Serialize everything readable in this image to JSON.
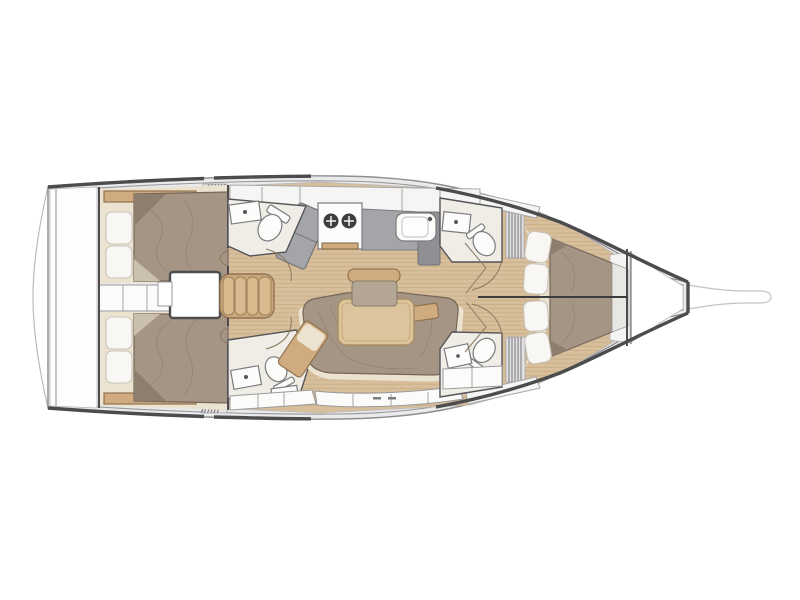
{
  "diagram": {
    "title": "Sailing yacht interior deck plan (top view)",
    "type": "yacht-floor-plan",
    "orientation": {
      "bow": "right",
      "stern": "left",
      "port": "top",
      "starboard": "bottom"
    },
    "layout_version": "4 cabins / 4 heads",
    "rooms": [
      {
        "id": "swim-platform",
        "label": "Swim platform (transom)"
      },
      {
        "id": "lazarette",
        "label": "Stern locker"
      },
      {
        "id": "aft-cabin-port",
        "label": "Aft double cabin - port",
        "furniture": [
          "double berth",
          "2 pillows",
          "shelf trim"
        ]
      },
      {
        "id": "aft-cabin-starboard",
        "label": "Aft double cabin - starboard",
        "furniture": [
          "double berth",
          "2 pillows",
          "shelf trim"
        ]
      },
      {
        "id": "companionway",
        "label": "Companionway steps with engine box"
      },
      {
        "id": "head-aft-port",
        "label": "Aft heads - port",
        "fixtures": [
          "washbasin",
          "toilet"
        ]
      },
      {
        "id": "head-aft-starboard",
        "label": "Aft heads - starboard",
        "fixtures": [
          "washbasin",
          "toilet",
          "shower"
        ]
      },
      {
        "id": "galley",
        "label": "Galley - port side",
        "fixtures": [
          "two-burner stove",
          "sink",
          "refrigerator",
          "cabinets"
        ]
      },
      {
        "id": "saloon",
        "label": "Saloon",
        "furniture": [
          "U-shaped settee",
          "dining table",
          "bench seat",
          "chaise end"
        ]
      },
      {
        "id": "head-forward-port",
        "label": "Forward heads - port",
        "fixtures": [
          "washbasin",
          "toilet"
        ]
      },
      {
        "id": "head-forward-starboard",
        "label": "Forward heads - starboard",
        "fixtures": [
          "shower",
          "toilet"
        ]
      },
      {
        "id": "forward-cabin",
        "label": "Forward cabin",
        "furniture": [
          "split V-berth",
          "4 pillows"
        ]
      },
      {
        "id": "forepeak",
        "label": "Forepeak / anchor locker"
      },
      {
        "id": "bowsprit",
        "label": "Bowsprit"
      }
    ],
    "colors": {
      "background": "#ffffff",
      "deck": "#eaeaec",
      "hull_outline": "#4c4c4e",
      "hull_inner": "#98989a",
      "platform_stroke": "#bcbcbe",
      "wood_floor": "#d8bf9b",
      "wood_plank_line": "#c1a47d",
      "wood_trim": "#cfab7f",
      "table_top": "#dcc49c",
      "stairs": "#caa87e",
      "mattress": "#a59585",
      "mattress_fold": "#8d7e6e",
      "cushion": "#b3a695",
      "cream_trim": "#ebe2d0",
      "pillow": "#f8f7f3",
      "room_floor": "#f0ede7",
      "fixture_white": "#fcfcfb",
      "counter": "#a3a5a8",
      "counter_dark": "#8e9093",
      "cabinet_white": "#f5f5f3",
      "locker_white": "#fbfbfa",
      "burner_dark": "#3e3e40",
      "centerline": "#3c3c3e",
      "door_arc": "#8a7a5f",
      "hatch_line": "#6a6a6c"
    }
  }
}
